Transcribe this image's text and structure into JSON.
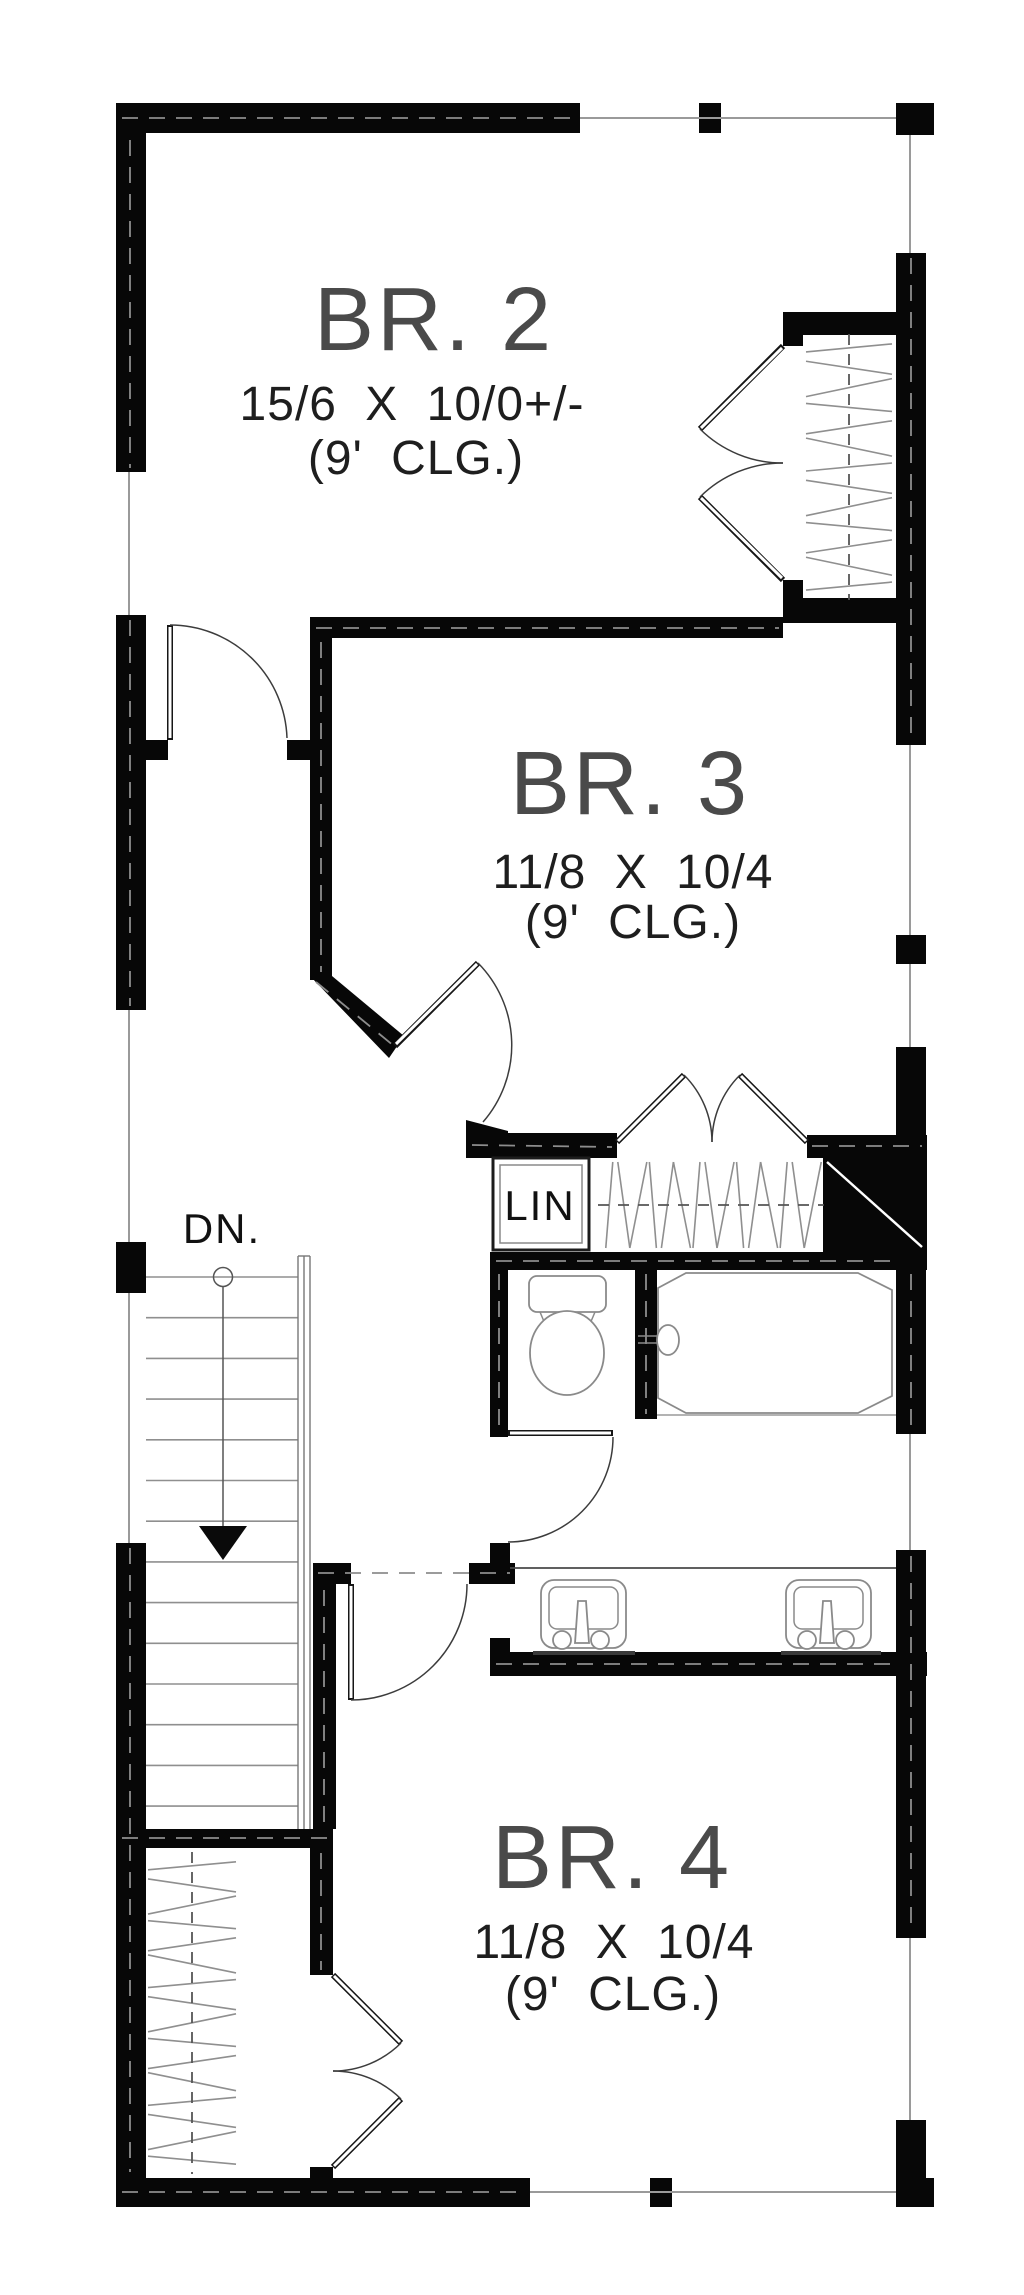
{
  "plan": {
    "type": "second-floor bedroom level floor plan",
    "rooms": {
      "br2": {
        "name": "BR. 2",
        "dims": "15/6 X 10/0+/-",
        "ceiling": "(9' CLG.)"
      },
      "br3": {
        "name": "BR. 3",
        "dims": "11/8 X 10/4",
        "ceiling": "(9' CLG.)"
      },
      "br4": {
        "name": "BR. 4",
        "dims": "11/8 X 10/4",
        "ceiling": "(9' CLG.)"
      }
    },
    "labels": {
      "linen_closet": "LIN",
      "stairs_down": "DN."
    },
    "stairs": {
      "direction_label": "DN.",
      "tread_count": 14,
      "arrow": "down"
    },
    "fixtures": [
      "toilet",
      "bathtub",
      "double-vanity-sinks",
      "closet-hanging-rods"
    ],
    "colors": {
      "wall": "#070707",
      "window_line": "#9a9a9a",
      "fixture_line": "#8a8a8a",
      "room_name_text": "#4a4a4a",
      "dims_text": "#1e1e1e",
      "background": "#ffffff"
    }
  }
}
